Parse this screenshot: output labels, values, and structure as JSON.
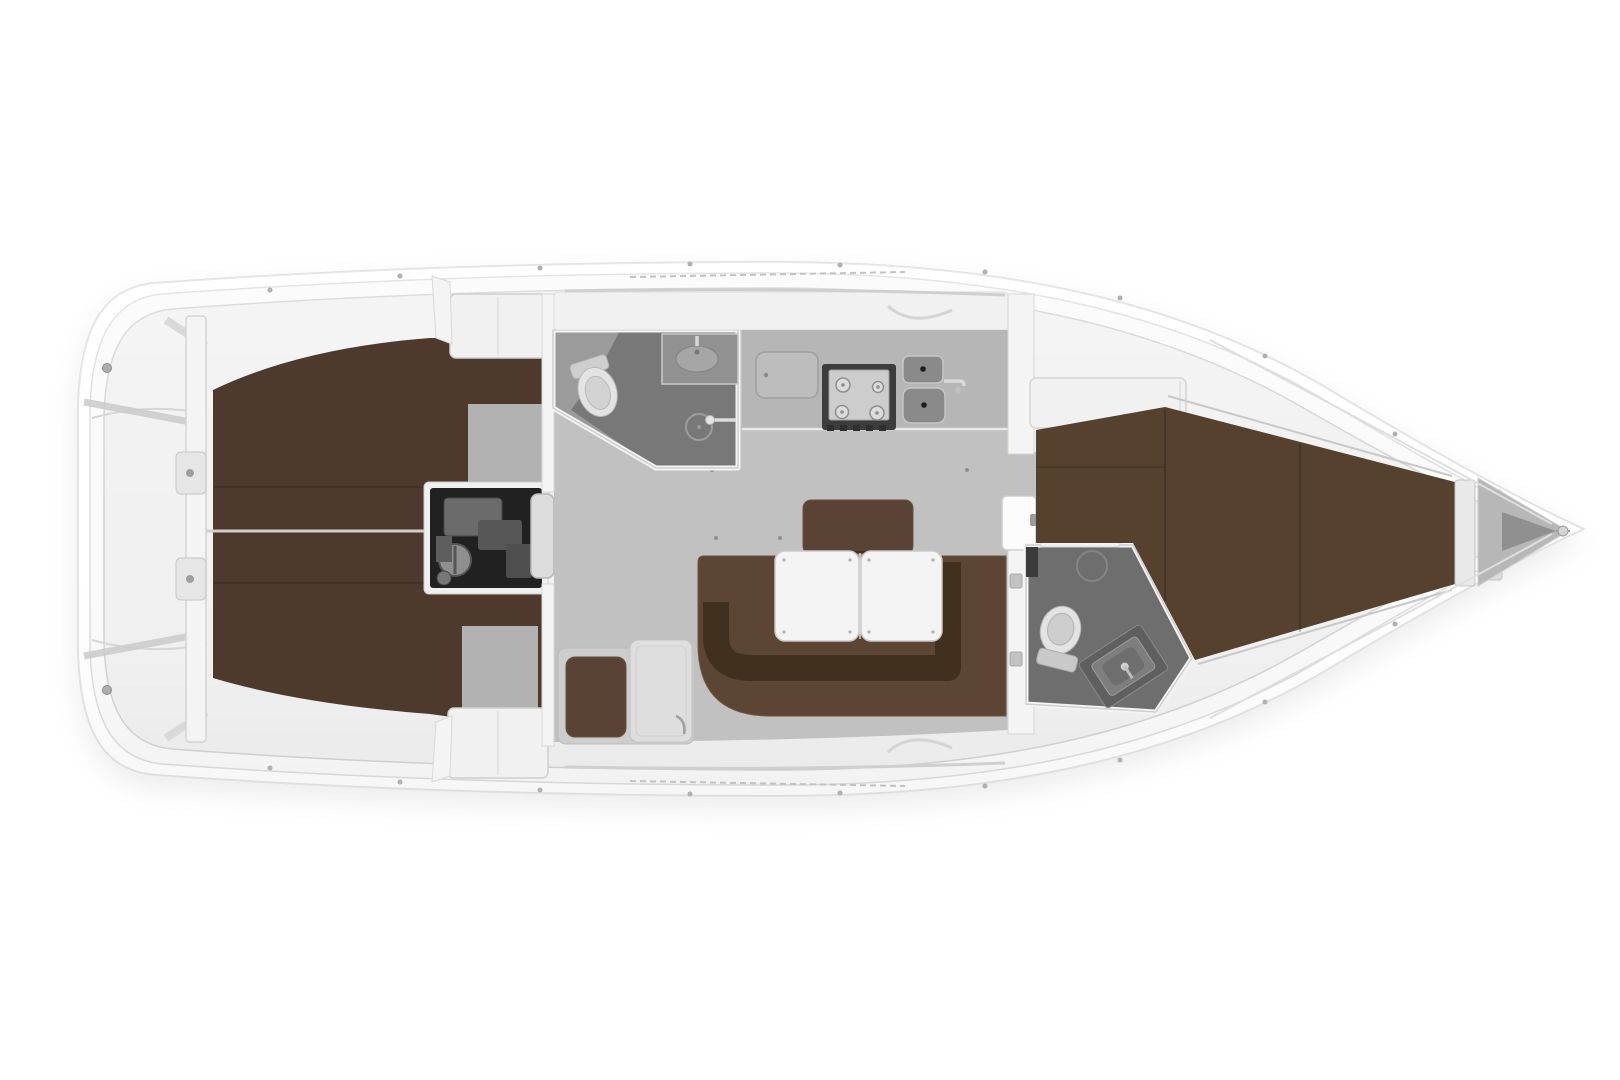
{
  "diagram": {
    "type": "floor-plan",
    "subject": "sailing-yacht-interior-top-view",
    "orientation": "bow-right",
    "areas": [
      "swim-platform",
      "cockpit",
      "aft-cabin-port",
      "aft-cabin-starboard",
      "engine-compartment",
      "companionway-steps",
      "aft-head",
      "galley",
      "salon",
      "u-settee",
      "folding-table",
      "forward-head",
      "forward-cabin-v-berth",
      "anchor-locker"
    ],
    "fixtures": [
      "toilet",
      "washbasin",
      "shower",
      "stove",
      "double-sink",
      "refrigerator",
      "wardrobe",
      "berth-cushions",
      "door",
      "bow-fitting"
    ]
  },
  "colors": {
    "background": "#ffffff",
    "hull_fill": "#ffffff",
    "hull_stroke": "#e2e2e2",
    "deck": "#fafafa",
    "deck_inner": "#f1f1f1",
    "deck_line": "#d2d2d2",
    "floor": "#c1c1c1",
    "floor_dark": "#b2b2b2",
    "berth_brown": "#4e3a2d",
    "berth_brown_light": "#56412f",
    "settee_brown": "#5d4533",
    "settee_back": "#42301f",
    "seatback_brown": "#5a4334",
    "head_floor": "#9b9b9b",
    "head_floor_dark": "#787878",
    "fwd_head_floor": "#6e6e6e",
    "counter": "#b6b6b6",
    "stove_frame": "#3c3c3c",
    "stove_top": "#cdcdcd",
    "sink_basin": "#8a8a8a",
    "engine_dark": "#212121",
    "steps": "#dcdcdc",
    "table_white": "#f4f4f4",
    "wall_white": "#f4f4f4",
    "cabinet_white": "#f1f1f1",
    "fixture_white": "#e3e3e3",
    "anchor_locker": "#b7b7b7",
    "hardware_gray": "#aeaeae",
    "module_gray": "#dedede",
    "surround_gray": "#cdcdcd"
  }
}
